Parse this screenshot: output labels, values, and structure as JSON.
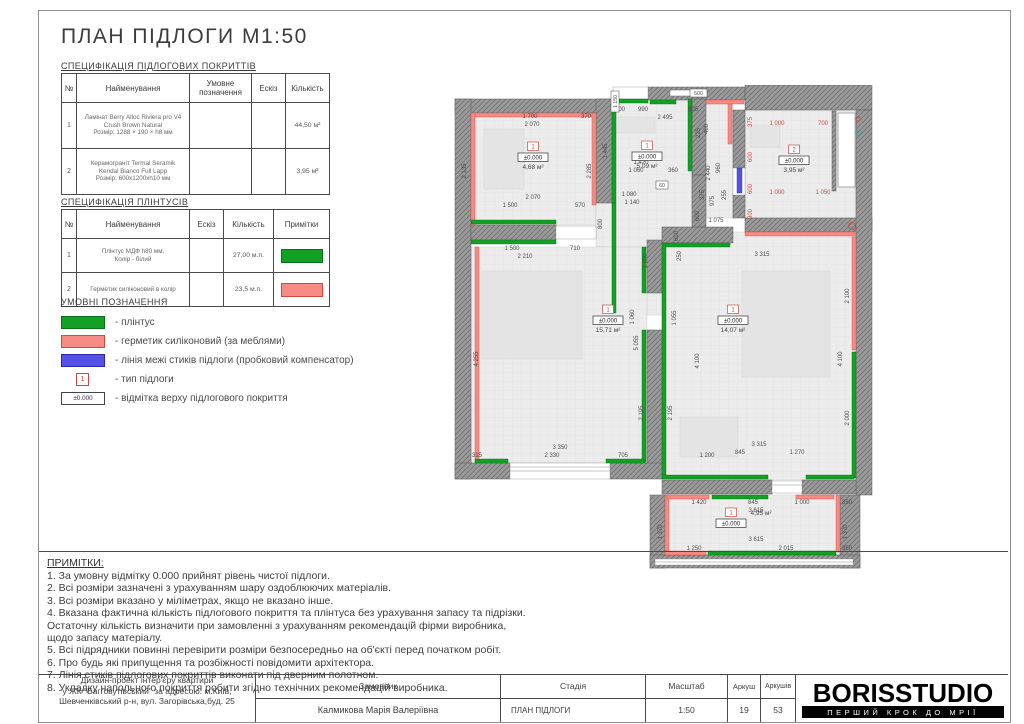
{
  "title": "ПЛАН ПІДЛОГИ М1:50",
  "colors": {
    "green": "#12a025",
    "green_border": "#0b6e18",
    "red": "#f58b84",
    "red_border": "#cc4a42",
    "blue": "#5550e6",
    "blue_border": "#2b28a8",
    "dim": "#4d4d4d",
    "dim_red": "#cc4a42",
    "wall": "#9b9b9b",
    "hatch": "#6f6f6f",
    "floor": "#ececec"
  },
  "spec_floor": {
    "label": "СПЕЦИФІКАЦІЯ ПІДЛОГОВИХ ПОКРИТТІВ",
    "headers": [
      "№",
      "Найменування",
      "Умовне позначення",
      "Ескіз",
      "Кількість"
    ],
    "rows": [
      {
        "num": "1",
        "name": [
          "Ламінат Berry Alloc Riviera pro V4",
          "Crush Brown Natural",
          "Розмір: 1288 × 190 × h8 мм"
        ],
        "symbol": "sym-planks",
        "sketch": "sk-wood",
        "qty": "44,50 м²"
      },
      {
        "num": "2",
        "name": [
          "Керамограніт Termal Seramik",
          "Kendal Bianco Full Lapp",
          "Розмір: 600x1200xh10 мм"
        ],
        "symbol": "sym-tiles",
        "sketch": "sk-marble",
        "qty": "3,95 м²"
      }
    ]
  },
  "spec_plinth": {
    "label": "СПЕЦИФІКАЦІЯ ПЛІНТУСІВ",
    "headers": [
      "№",
      "Найменування",
      "Ескіз",
      "Кількість",
      "Примітки"
    ],
    "rows": [
      {
        "num": "1",
        "name": [
          "Плінтус МДФ h80 мм,",
          "Колір - білий"
        ],
        "sketch": "sk-plinth",
        "qty": "27,00 м.п.",
        "note_color": "#12a025",
        "note_border": "#0b6e18"
      },
      {
        "num": "2",
        "name": [
          "Герметик силіконовий в колір"
        ],
        "sketch": "sk-sealant",
        "qty": "23,5 м.п.",
        "note_color": "#f58b84",
        "note_border": "#cc4a42"
      }
    ]
  },
  "legend": {
    "title": "УМОВНІ ПОЗНАЧЕННЯ",
    "items": [
      {
        "kind": "green",
        "label": "- плінтус"
      },
      {
        "kind": "red",
        "label": "- герметик силіконовий (за меблями)"
      },
      {
        "kind": "blue",
        "label": "- лінія межі стиків підлоги (пробковий компенсатор)"
      },
      {
        "kind": "type",
        "mark": "1",
        "label": "- тип підлоги"
      },
      {
        "kind": "elev",
        "mark": "±0.000",
        "label": "- відмітка верху підлогового покриття"
      }
    ]
  },
  "notes": {
    "title": "ПРИМІТКИ:",
    "lines": [
      "1. За умовну відмітку 0.000 прийнят рівень чистої підлоги.",
      "2. Всі розміри зазначені з урахуванням шару оздоблюючих матеріалів.",
      "3. Всі розміри вказано у міліметрах, якщо не вказано інше.",
      "4. Вказана фактична кількість підлогового покриття та плінтуса без урахування запасу та підрізки.",
      "Остаточну кількість визначити при замовленні з урахуванням рекомендацій фірми виробника,",
      "щодо запасу матеріалу.",
      "5. Всі підрядники повинні перевірити розміри безпосередньо на об'єкті перед початком робіт.",
      "6. Про будь які припущення та розбіжності повідомити архітектора.",
      "7.  Лінія стиків підлогових покриттів виконати під дверним полотном.",
      "8. Укладку напольного покриття робити згідно технічних рекомендацій виробника."
    ]
  },
  "titleblock": {
    "project_lines": [
      "Дизайн-проект інтер'єру квартири",
      "у ЖК \"Багговутівський\" за адресою: м.Київ,",
      "Шевченківський р-н, вул. Загорівська,буд. 25"
    ],
    "customer_label": "Замовник",
    "customer_name": "Калмикова Марія Валеріївна",
    "stage_label": "Стадія",
    "stage_value": "ПЛАН ПІДЛОГИ",
    "scale_label": "Масштаб",
    "scale_value": "1:50",
    "sheet_label": "Аркуш",
    "sheet_value": "19",
    "sheets_label": "Аркушів",
    "sheets_value": "53",
    "logo": "BORISSTUDIO",
    "logo_tagline": "ПЕРШИЙ КРОК ДО МРІЇ"
  },
  "plan": {
    "floors": [
      [
        21,
        28,
        125,
        112
      ],
      [
        146,
        118,
        16,
        44
      ],
      [
        162,
        14,
        80,
        216
      ],
      [
        242,
        14,
        41,
        119
      ],
      [
        295,
        25,
        111,
        108
      ],
      [
        21,
        162,
        176,
        216
      ],
      [
        212,
        147,
        194,
        248
      ],
      [
        215,
        410,
        175,
        61
      ]
    ],
    "furniture": [
      [
        32,
        186,
        100,
        88
      ],
      [
        292,
        186,
        88,
        106
      ],
      [
        230,
        332,
        58,
        40
      ],
      [
        300,
        40,
        30,
        22
      ],
      [
        165,
        32,
        40,
        16
      ],
      [
        34,
        44,
        40,
        60
      ]
    ],
    "walls": [
      [
        5,
        14,
        158,
        14
      ],
      [
        198,
        2,
        97,
        13
      ],
      [
        295,
        0,
        127,
        25
      ],
      [
        5,
        14,
        16,
        380
      ],
      [
        146,
        14,
        16,
        104
      ],
      [
        21,
        140,
        85,
        15
      ],
      [
        242,
        14,
        14,
        76
      ],
      [
        283,
        25,
        12,
        58
      ],
      [
        283,
        108,
        12,
        25
      ],
      [
        295,
        133,
        127,
        14
      ],
      [
        406,
        25,
        16,
        385
      ],
      [
        197,
        155,
        15,
        53
      ],
      [
        197,
        245,
        15,
        140
      ],
      [
        212,
        142,
        71,
        16
      ],
      [
        242,
        90,
        14,
        52
      ],
      [
        5,
        378,
        55,
        16
      ],
      [
        160,
        378,
        52,
        16
      ],
      [
        212,
        395,
        110,
        14
      ],
      [
        352,
        395,
        54,
        14
      ],
      [
        200,
        410,
        15,
        73
      ],
      [
        390,
        410,
        20,
        73
      ],
      [
        200,
        470,
        210,
        13
      ],
      [
        382,
        26,
        4,
        80
      ]
    ],
    "whites": [
      [
        106,
        141,
        40,
        13
      ],
      [
        163,
        2,
        35,
        12
      ],
      [
        60,
        378,
        100,
        16
      ],
      [
        322,
        396,
        30,
        12
      ],
      [
        205,
        474,
        198,
        6
      ],
      [
        283,
        83,
        12,
        27
      ]
    ],
    "window_lines": [
      [
        60,
        382,
        160,
        382
      ],
      [
        60,
        386,
        160,
        386
      ],
      [
        322,
        400,
        352,
        400
      ],
      [
        205,
        477,
        403,
        477
      ]
    ],
    "bands": [
      [
        "r",
        21,
        28,
        125,
        4
      ],
      [
        "r",
        21,
        28,
        4,
        112
      ],
      [
        "r",
        142,
        28,
        4,
        92
      ],
      [
        "g",
        21,
        135,
        85,
        4
      ],
      [
        "g",
        21,
        155,
        85,
        4
      ],
      [
        "g",
        162,
        14,
        4,
        104
      ],
      [
        "g",
        162,
        14,
        36,
        4
      ],
      [
        "g",
        200,
        15,
        26,
        4
      ],
      [
        "r",
        256,
        15,
        38,
        4
      ],
      [
        "g",
        238,
        14,
        4,
        72
      ],
      [
        "g",
        162,
        118,
        4,
        110
      ],
      [
        "r",
        278,
        19,
        4,
        40
      ],
      [
        "b",
        287,
        83,
        5,
        25
      ],
      [
        "r",
        295,
        147,
        111,
        4
      ],
      [
        "g",
        212,
        158,
        4,
        232
      ],
      [
        "g",
        216,
        158,
        64,
        4
      ],
      [
        "r",
        402,
        152,
        4,
        113
      ],
      [
        "g",
        402,
        267,
        4,
        126
      ],
      [
        "g",
        212,
        390,
        106,
        4
      ],
      [
        "g",
        356,
        390,
        48,
        4
      ],
      [
        "r",
        25,
        162,
        4,
        214
      ],
      [
        "g",
        192,
        162,
        4,
        46
      ],
      [
        "g",
        192,
        245,
        4,
        132
      ],
      [
        "g",
        25,
        374,
        33,
        4
      ],
      [
        "g",
        156,
        374,
        39,
        4
      ],
      [
        "r",
        215,
        410,
        4,
        57
      ],
      [
        "r",
        386,
        410,
        4,
        57
      ],
      [
        "g",
        262,
        410,
        56,
        4
      ],
      [
        "r",
        217,
        410,
        42,
        4
      ],
      [
        "r",
        346,
        410,
        38,
        4
      ],
      [
        "g",
        258,
        466,
        128,
        4
      ],
      [
        "r",
        215,
        466,
        41,
        4
      ]
    ],
    "fixtures": [
      [
        388,
        28,
        17,
        74
      ],
      [
        220,
        5,
        30,
        6
      ]
    ],
    "circles": [
      [
        408,
        34,
        2.2,
        "#cc4444"
      ],
      [
        408,
        48,
        2.2,
        "#2aa7a7"
      ],
      [
        402,
        141,
        3.5,
        "#cc4444"
      ]
    ],
    "boxdims": [
      [
        "500",
        240,
        4,
        17,
        8
      ],
      [
        "1 150",
        161,
        6,
        8,
        21,
        "v"
      ],
      [
        "60",
        206,
        96,
        12,
        8
      ]
    ],
    "dims": [
      [
        "1 700",
        80,
        33
      ],
      [
        "370",
        136,
        33
      ],
      [
        "2 070",
        82,
        41
      ],
      [
        "2 135",
        16,
        86,
        "v"
      ],
      [
        "2 285",
        141,
        86,
        "v"
      ],
      [
        "2 070",
        83,
        114
      ],
      [
        "1 500",
        60,
        122
      ],
      [
        "570",
        130,
        122
      ],
      [
        "1 500",
        62,
        165
      ],
      [
        "710",
        125,
        165
      ],
      [
        "2 210",
        75,
        173
      ],
      [
        "200",
        170,
        26
      ],
      [
        "990",
        193,
        26
      ],
      [
        "805",
        243,
        26
      ],
      [
        "2 495",
        215,
        34
      ],
      [
        "1 445",
        157,
        66,
        "v"
      ],
      [
        "1 420",
        191,
        79
      ],
      [
        "1 060",
        186,
        87
      ],
      [
        "360",
        223,
        87
      ],
      [
        "1 080",
        179,
        111
      ],
      [
        "1 140",
        182,
        119
      ],
      [
        "800",
        152,
        139,
        "v"
      ],
      [
        "1 800",
        197,
        176,
        "v"
      ],
      [
        "2 440",
        260,
        88,
        "v"
      ],
      [
        "960",
        270,
        83,
        "v"
      ],
      [
        "375",
        254,
        110,
        "v"
      ],
      [
        "975",
        264,
        116,
        "v"
      ],
      [
        "600",
        249,
        131,
        "v"
      ],
      [
        "255",
        276,
        110,
        "v"
      ],
      [
        "1 075",
        266,
        137
      ],
      [
        "225",
        250,
        48,
        "v"
      ],
      [
        "400",
        258,
        44,
        "v"
      ],
      [
        "600",
        228,
        151,
        "v"
      ],
      [
        "250",
        231,
        171,
        "v"
      ],
      [
        "375",
        302,
        37,
        "v",
        "r"
      ],
      [
        "1 000",
        327,
        40,
        0,
        "r"
      ],
      [
        "700",
        373,
        40,
        0,
        "r"
      ],
      [
        "600",
        302,
        72,
        "v",
        "r"
      ],
      [
        "600",
        302,
        104,
        "v",
        "r"
      ],
      [
        "1 000",
        327,
        109,
        0,
        "r"
      ],
      [
        "1 050",
        373,
        109,
        0,
        "r"
      ],
      [
        "900",
        302,
        129,
        "v",
        "r"
      ],
      [
        "4 255",
        28,
        274,
        "v"
      ],
      [
        "5 055",
        188,
        258,
        "v"
      ],
      [
        "1 060",
        184,
        232,
        "v"
      ],
      [
        "2 195",
        193,
        328,
        "v"
      ],
      [
        "3 350",
        110,
        364
      ],
      [
        "315",
        27,
        372
      ],
      [
        "2 330",
        102,
        372
      ],
      [
        "705",
        173,
        372
      ],
      [
        "1 055",
        226,
        233,
        "v"
      ],
      [
        "2 195",
        222,
        328,
        "v"
      ],
      [
        "4 100",
        249,
        276,
        "v"
      ],
      [
        "3 315",
        312,
        171
      ],
      [
        "2 100",
        399,
        211,
        "v"
      ],
      [
        "4 100",
        392,
        274,
        "v"
      ],
      [
        "2 000",
        399,
        333,
        "v"
      ],
      [
        "3 315",
        309,
        361
      ],
      [
        "845",
        290,
        369
      ],
      [
        "1 270",
        347,
        369
      ],
      [
        "1 200",
        257,
        372
      ],
      [
        "1 420",
        249,
        419
      ],
      [
        "845",
        303,
        419
      ],
      [
        "1 000",
        352,
        419
      ],
      [
        "350",
        397,
        419
      ],
      [
        "3 615",
        306,
        427
      ],
      [
        "1 370",
        212,
        447,
        "v"
      ],
      [
        "1 370",
        397,
        447,
        "v"
      ],
      [
        "3 615",
        306,
        456
      ],
      [
        "1 250",
        244,
        465
      ],
      [
        "2 015",
        336,
        465
      ],
      [
        "350",
        397,
        465
      ]
    ],
    "rooms": [
      {
        "type": "1",
        "elev": "±0.000",
        "area": "4,68 м²",
        "x": 83,
        "y": 57
      },
      {
        "type": "1",
        "elev": "±0.000",
        "area": "5,09 м²",
        "x": 197,
        "y": 56
      },
      {
        "type": "2",
        "elev": "±0.000",
        "area": "3,95 м²",
        "x": 344,
        "y": 60
      },
      {
        "type": "1",
        "elev": "±0.000",
        "area": "15,71 м²",
        "x": 158,
        "y": 220
      },
      {
        "type": "1",
        "elev": "±0.000",
        "area": "14,07 м²",
        "x": 283,
        "y": 220
      },
      {
        "type": "1",
        "elev": "±0.000",
        "area": "4,95 м²",
        "x": 281,
        "y": 423,
        "balcony": true
      }
    ]
  }
}
